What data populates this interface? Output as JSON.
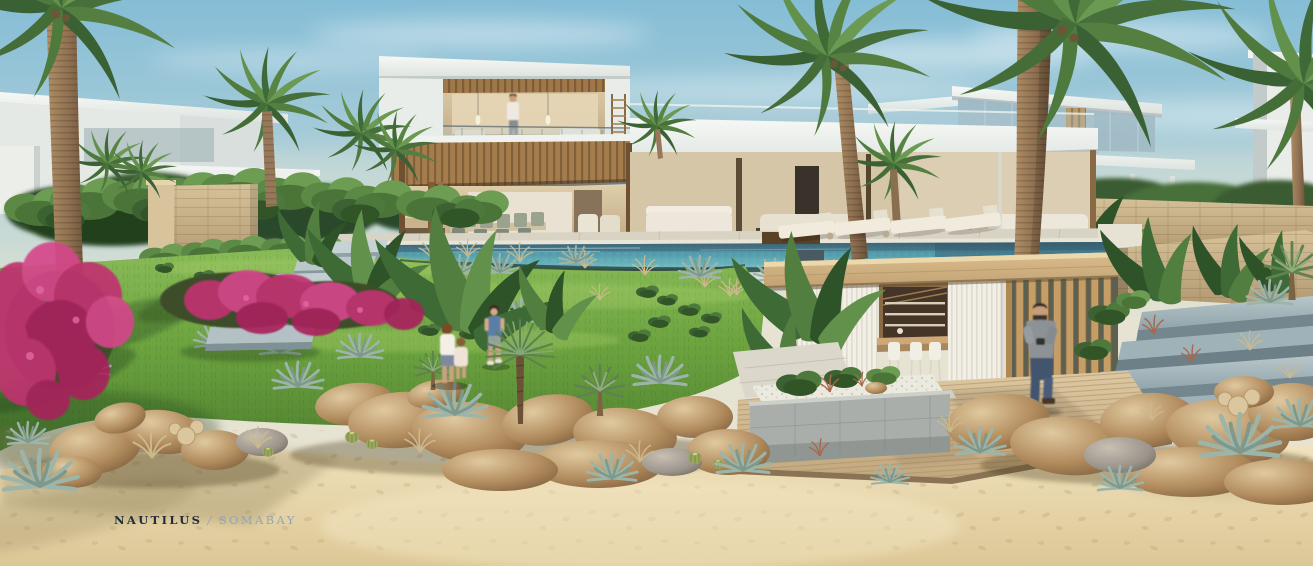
{
  "watermark": {
    "brand": "NAUTILUS",
    "separator": "/",
    "location": "SOMABAY"
  },
  "scene": {
    "type": "architectural-exterior-rendering",
    "subject": "Modern two-storey beachfront villa with infinity pool, tropical garden, pool cabana and sandy beach foreground",
    "time_of_day": "daytime, clear sky",
    "people": [
      "man standing at the upper-floor glass balcony",
      "two children playing on the lawn",
      "boy walking on the lawn",
      "man walking on the wooden cabana deck"
    ],
    "landscape": [
      "date palms",
      "bougainvillea in magenta bloom",
      "blue agaves",
      "yucca trees",
      "barrel cacti",
      "desert grasses",
      "rock boulders",
      "golden sand with footprints"
    ],
    "architecture": [
      "white cantilevered slab roofs",
      "timber slatted ceilings",
      "glass balustrades",
      "open-plan living and dining",
      "infinity-edge pool",
      "timber cabana with sheer curtains",
      "stone garden walls with floating steps",
      "timber deck"
    ],
    "palette": {
      "sky": "#85bdd6",
      "pool_water": "#57a3b2",
      "lawn": "#6ea441",
      "sand": "#e9d9b3",
      "stone_wall": "#c9b28a",
      "timber": "#c8a06b",
      "white_structure": "#eef1ee",
      "bougainvillea": "#c03070",
      "agave": "#93b0a4"
    }
  }
}
